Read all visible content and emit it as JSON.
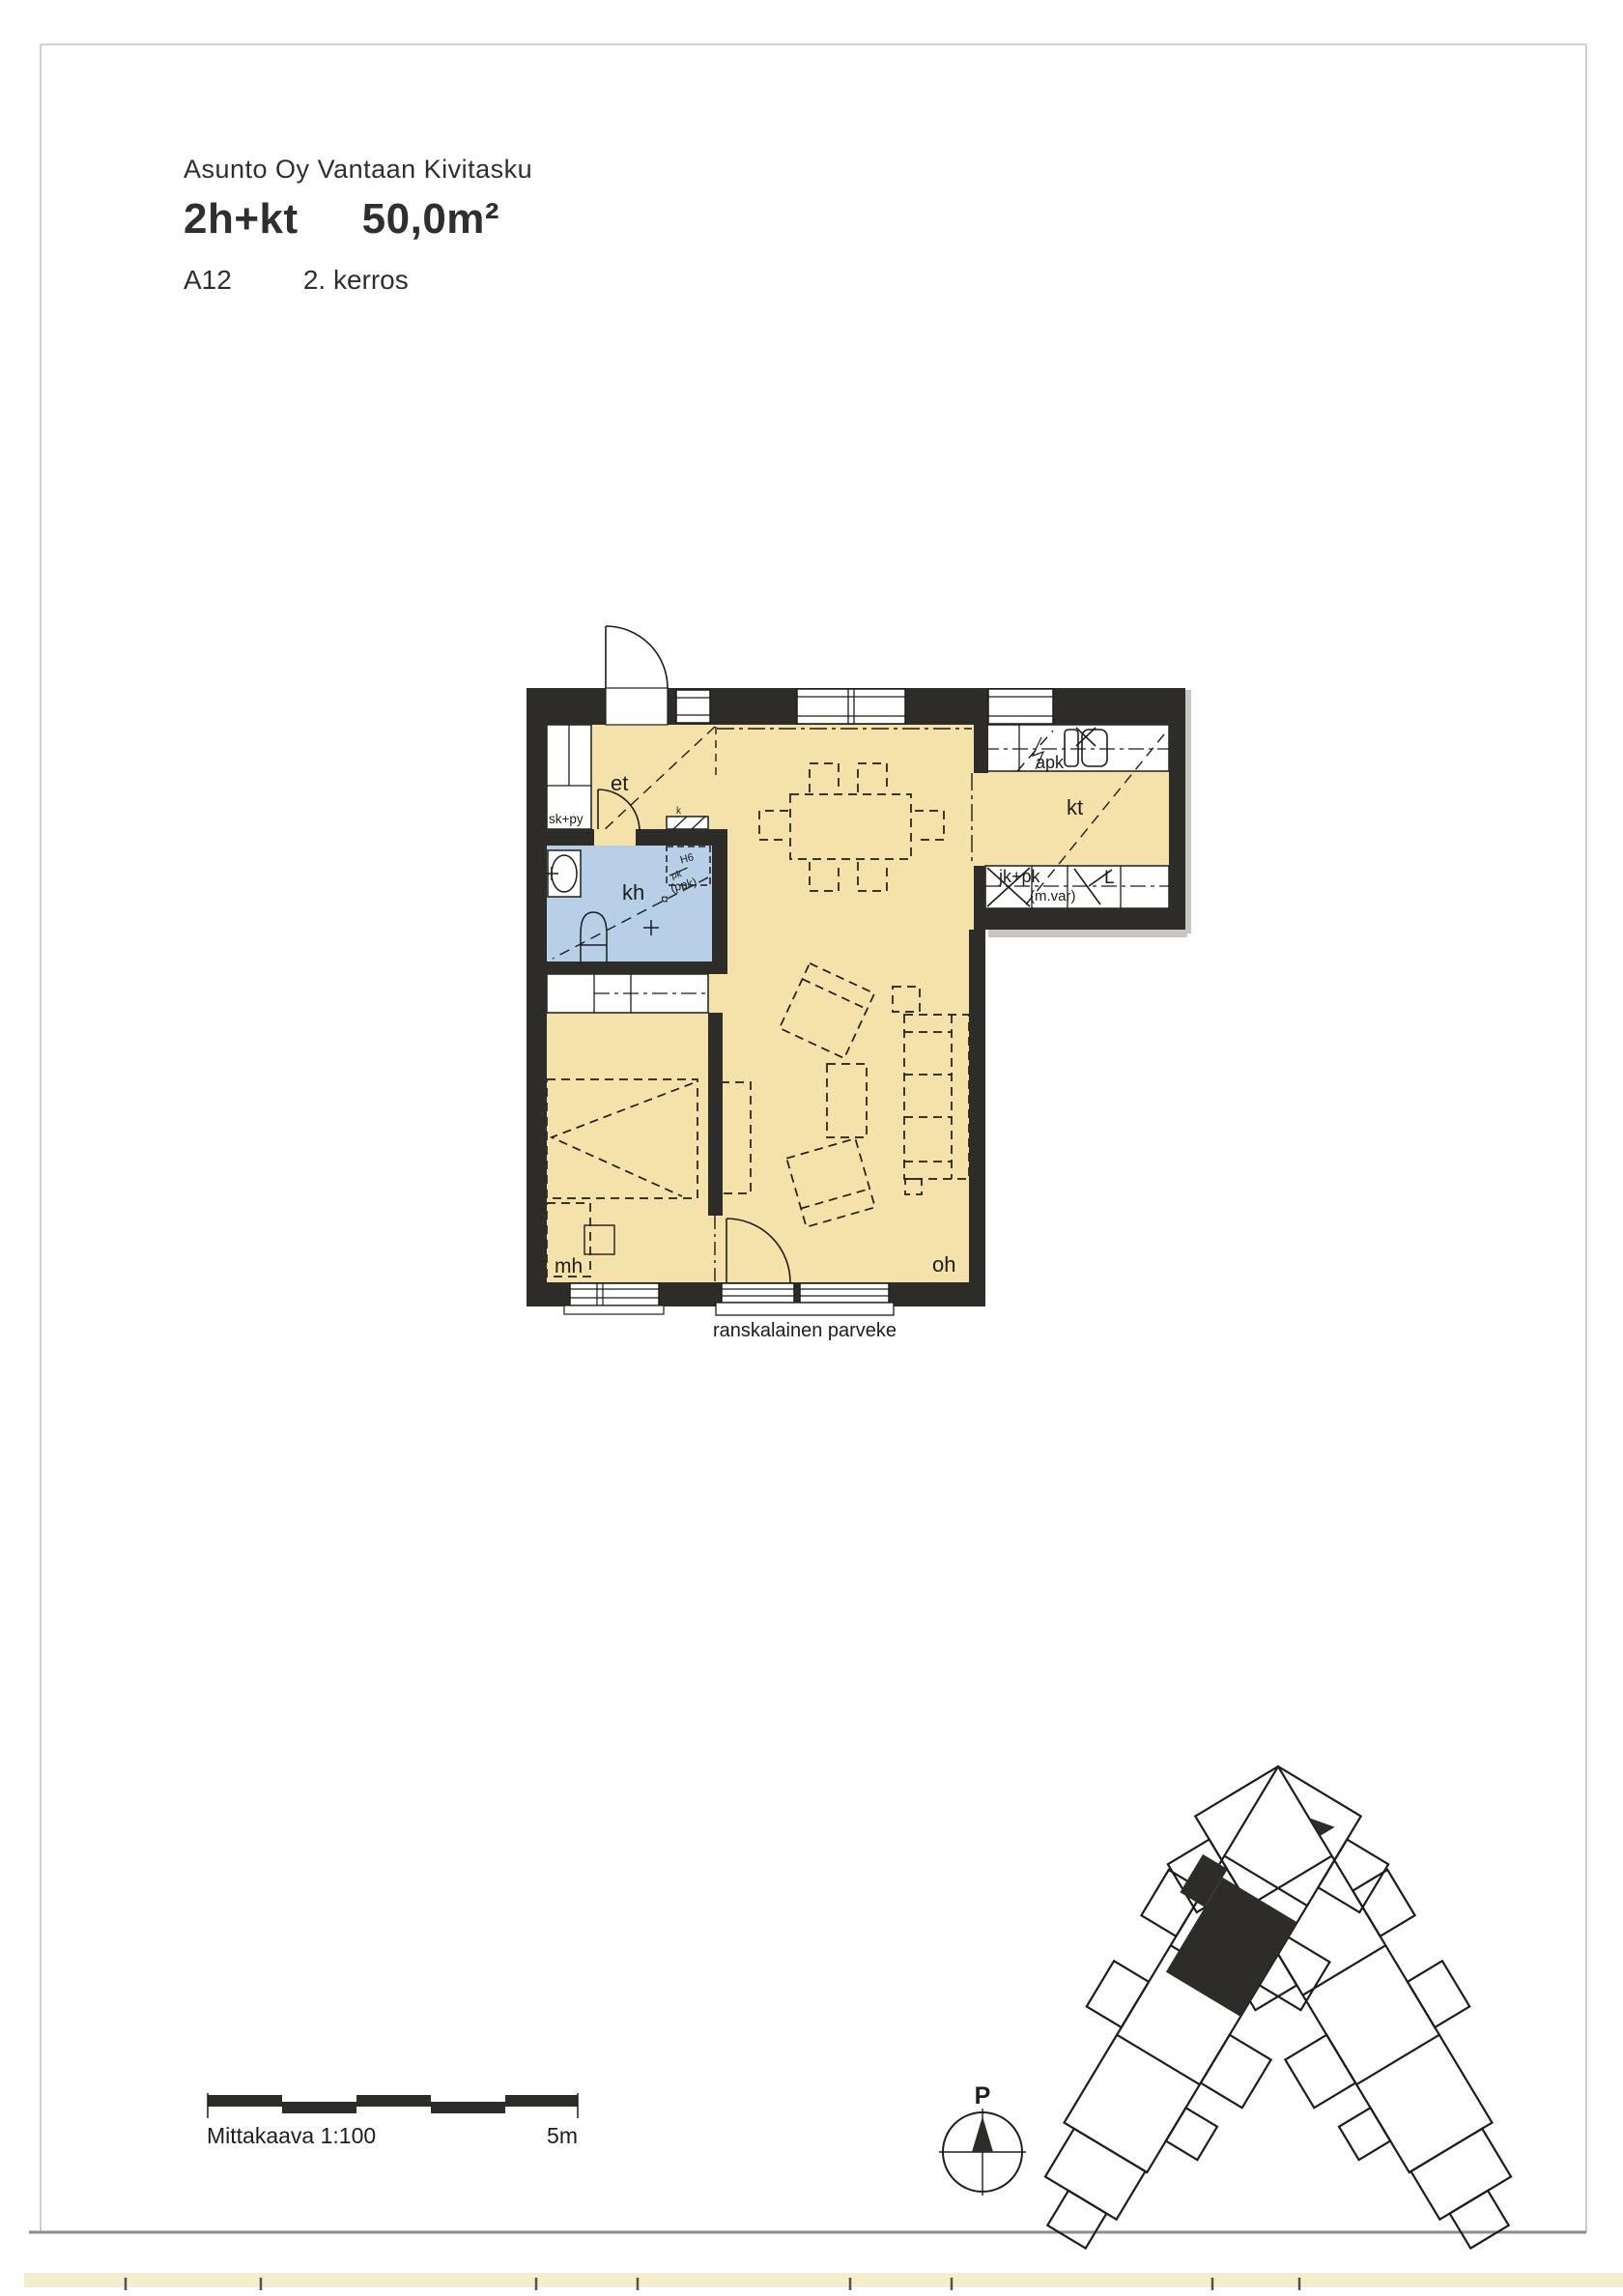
{
  "header": {
    "company": "Asunto Oy Vantaan Kivitasku",
    "apartment_type": "2h+kt",
    "area": "50,0m²",
    "apartment_id": "A12",
    "floor": "2. kerros"
  },
  "plan": {
    "rooms": {
      "et": "et",
      "kh": "kh",
      "mh": "mh",
      "oh": "oh",
      "kt": "kt"
    },
    "fixtures": {
      "closet": "sk+py",
      "dishwasher": "apk",
      "fridge": "jk+pk",
      "micro_reserve": "(m.var)",
      "stove": "L",
      "washer_reserve": "(ppk)",
      "washer_note": "H6",
      "washer_strike": "pk",
      "vent": "k",
      "drain": "¤"
    },
    "balcony_label": "ranskalainen parveke"
  },
  "scale_bar": {
    "label": "Mittakaava 1:100",
    "max_label": "5m"
  },
  "compass": {
    "north_label": "P"
  },
  "colors": {
    "wall": "#2e2c29",
    "floor": "#f5e2ab",
    "wet_floor": "#b7d0e8",
    "line": "#1d1d1b",
    "paper": "#ffffff",
    "scan_edge": "#f4eecd"
  }
}
